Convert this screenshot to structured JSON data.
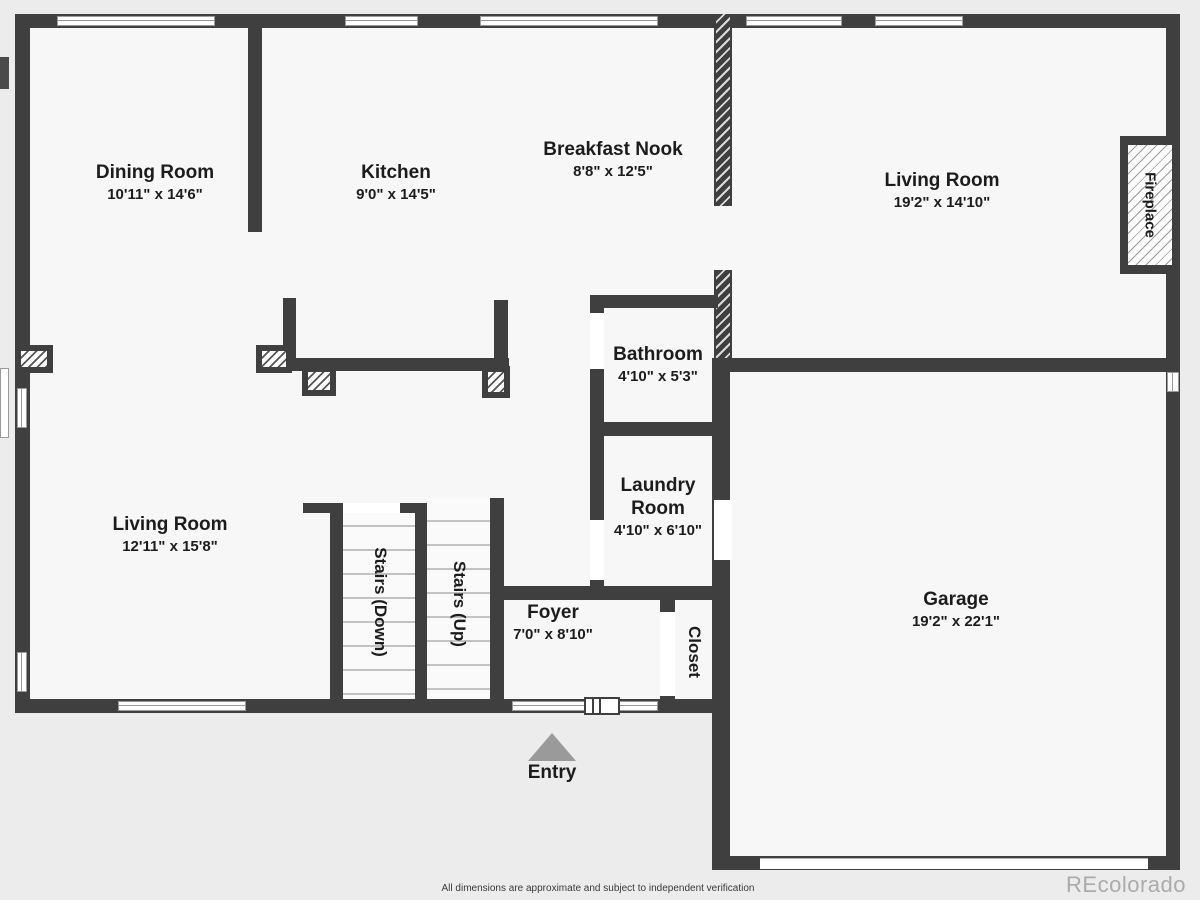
{
  "page": {
    "footer_disclaimer": "All dimensions are approximate and subject to independent verification",
    "watermark": "REcolorado"
  },
  "colors": {
    "wall": "#3f3f3f",
    "floor": "#f7f7f7",
    "background": "#ececec",
    "entry_arrow": "#9a9a9a",
    "label_text": "#1c1c1c",
    "watermark_text": "#ababab"
  },
  "rooms": {
    "dining": {
      "name": "Dining Room",
      "dims": "10'11\" x 14'6\""
    },
    "kitchen": {
      "name": "Kitchen",
      "dims": "9'0\" x 14'5\""
    },
    "breakfast_nook": {
      "name": "Breakfast Nook",
      "dims": "8'8\" x 12'5\""
    },
    "living_upper": {
      "name": "Living Room",
      "dims": "19'2\" x 14'10\""
    },
    "bathroom": {
      "name": "Bathroom",
      "dims": "4'10\" x 5'3\""
    },
    "laundry": {
      "name": "Laundry Room",
      "dims": "4'10\" x 6'10\""
    },
    "living_lower": {
      "name": "Living Room",
      "dims": "12'11\" x 15'8\""
    },
    "foyer": {
      "name": "Foyer",
      "dims": "7'0\" x 8'10\""
    },
    "garage": {
      "name": "Garage",
      "dims": "19'2\" x 22'1\""
    }
  },
  "features": {
    "fireplace": {
      "label": "Fireplace"
    },
    "stairs_down": {
      "label": "Stairs (Down)"
    },
    "stairs_up": {
      "label": "Stairs (Up)"
    },
    "closet": {
      "label": "Closet"
    },
    "entry": {
      "label": "Entry"
    }
  }
}
